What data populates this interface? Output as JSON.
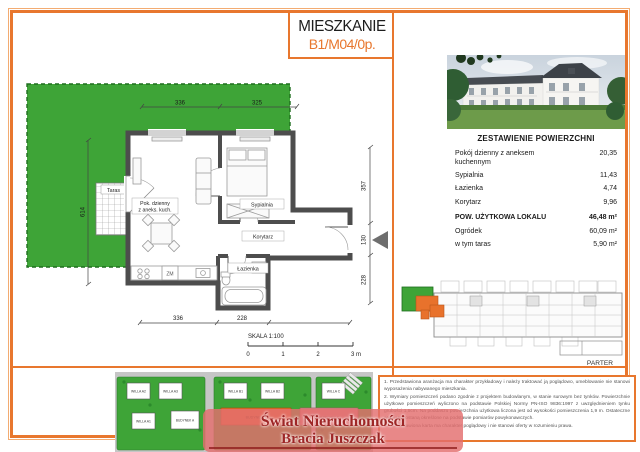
{
  "title": {
    "main": "MIESZKANIE",
    "unit": "B1/M04/0p."
  },
  "colors": {
    "accent": "#E8772E",
    "garden_green": "#3EA437",
    "wall_gray": "#4D4D4D",
    "logo_red": "#9E2626",
    "highlight_orange": "#E8722C"
  },
  "floorplan": {
    "label_taras": "Taras",
    "room_living_1": "Pok. dzienny",
    "room_living_2": "z aneks. kuch.",
    "room_sypialnia": "Sypialnia",
    "room_korytarz": "Korytarz",
    "room_lazienka": "Łazienka",
    "label_zm": "ZM",
    "dim_top_1": "336",
    "dim_top_2": "325",
    "dim_left": "614",
    "dim_bottom_1": "336",
    "dim_bottom_2": "228",
    "dim_right_1": "357",
    "dim_right_2": "130",
    "dim_right_3": "228",
    "scale_label": "SKALA 1:100",
    "scale_0": "0",
    "scale_1": "1",
    "scale_2": "2",
    "scale_3": "3 m"
  },
  "summary": {
    "header": "ZESTAWIENIE POWIERZCHNI",
    "rows": [
      {
        "label": "Pokój dzienny z aneksem kuchennym",
        "value": "20,35"
      },
      {
        "label": "Sypialnia",
        "value": "11,43"
      },
      {
        "label": "Łazienka",
        "value": "4,74"
      },
      {
        "label": "Korytarz",
        "value": "9,96"
      }
    ],
    "total": {
      "label": "POW. UŻYTKOWA LOKALU",
      "value": "46,48 m²"
    },
    "extra": [
      {
        "label": "Ogródek",
        "value": "60,09 m²"
      },
      {
        "label": "w tym taras",
        "value": "5,90 m²"
      }
    ]
  },
  "overview": {
    "floor_label": "PARTER"
  },
  "siteplan": {
    "willa_a2": "WILLA A2",
    "willa_a3": "WILLA A3",
    "willa_a1": "WILLA A1",
    "budynek_a": "BUDYNEK A",
    "willa_b1": "WILLA B1",
    "willa_b2": "WILLA B2",
    "willa_c": "WILLA C",
    "budynek_b": "BUDYNEK B",
    "budynek_c": "BUDYNEK C"
  },
  "notes": [
    "1. Przedstawiona aranżacja ma charakter przykładowy i należy traktować ją poglądowo, umeblowanie nie stanowi wyposażenia nabywanego mieszkania.",
    "2. Wymiary pomieszczeń podano zgodnie z projektem budowlanym, w stanie surowym bez tynków. Powierzchnie użytkowe pomieszczeń wyliczono na podstawie Polskiej Normy PN-ISO 9836:1997 z uwzględnieniem tynku grubości 1,5cm. Na poddaszu powierzchnia użytkowa liczona jest od wysokości pomieszczenia 1,9 m. Ostateczne wymiary zostaną określone na podstawie pomiarów powykonawczych.",
    "3. Przedstawiona karta ma charakter poglądowy i nie stanowi oferty w rozumieniu prawa."
  ],
  "logo": {
    "line1": "Świat Nieruchomości",
    "line2": "Bracia Juszczak"
  }
}
